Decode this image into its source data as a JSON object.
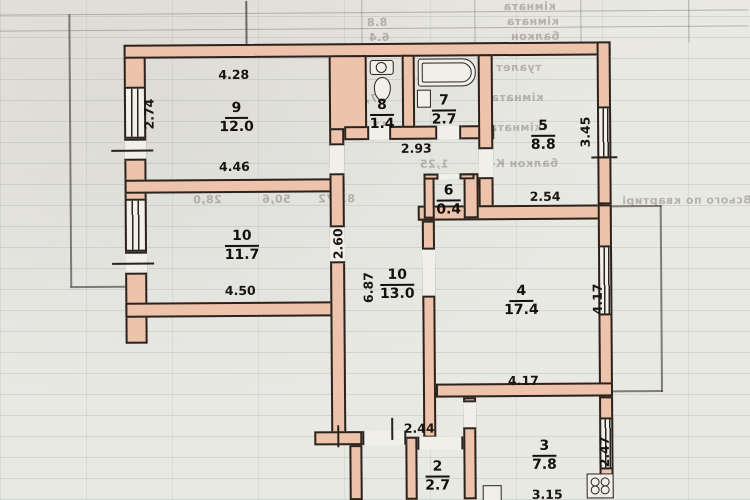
{
  "rooms": [
    {
      "num": "9",
      "area": "12.0"
    },
    {
      "num": "10",
      "area": "11.7"
    },
    {
      "num": "10",
      "area": "13.0"
    },
    {
      "num": "8",
      "area": "1.4"
    },
    {
      "num": "7",
      "area": "2.7"
    },
    {
      "num": "5",
      "area": "8.8"
    },
    {
      "num": "6",
      "area": "0.4"
    },
    {
      "num": "4",
      "area": "17.4"
    },
    {
      "num": "3",
      "area": "7.8"
    },
    {
      "num": "2",
      "area": "2.7"
    }
  ],
  "dims": {
    "room9_top": "4.28",
    "room9_left": "2.74",
    "room9_bottom": "4.46",
    "room10_bottom": "4.50",
    "hall_left": "2.60",
    "hall_height": "6.87",
    "hall_top": "2.93",
    "room5_right": "3.45",
    "room5_bottom": "2.54",
    "room4_right": "4.17",
    "room4_bottom": "4.17",
    "room3_right": "2.47",
    "room3_bottom": "3.15",
    "room2_top": "2.44"
  },
  "bleed_text": {
    "top_rows": [
      "кімната",
      "кімната",
      "балкон"
    ],
    "top_numbers": [
      "8.8",
      "6.4"
    ],
    "right_block": [
      "туалет",
      "кімната",
      "кімната",
      "балкон К-0."
    ],
    "mid_numbers": [
      "17,0",
      "11,3",
      "1,25"
    ],
    "totals": [
      "28,0",
      "50,6",
      "83,72",
      "Всього по квартирі"
    ]
  },
  "colors": {
    "wall_fill": "#eec3ab",
    "line": "#2a231d",
    "paper": "#e9e9e4"
  }
}
